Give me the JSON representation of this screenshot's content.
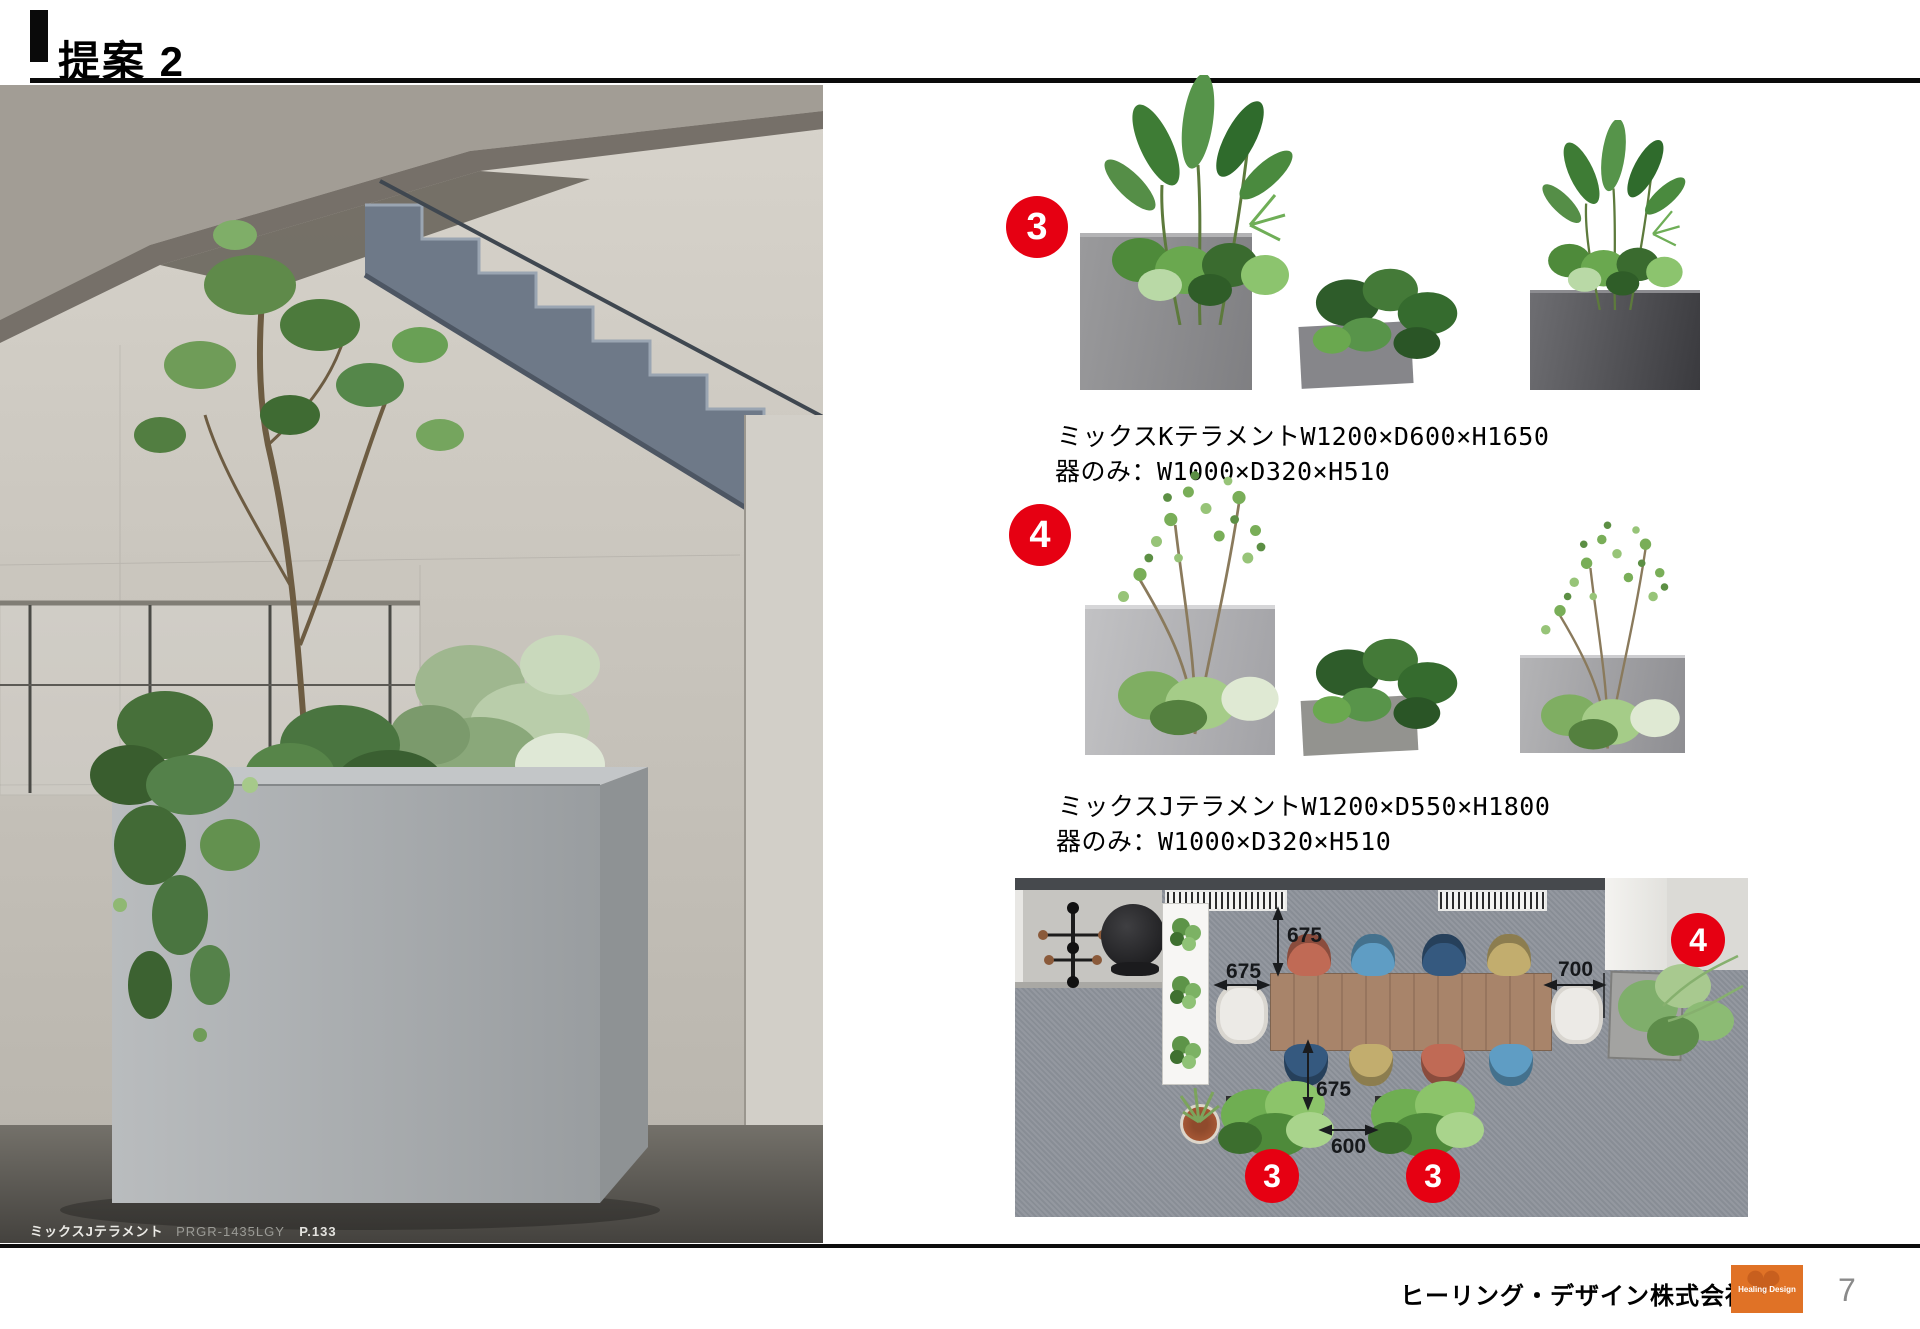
{
  "header": {
    "title": "提案 2"
  },
  "photo": {
    "caption": {
      "name": "ミックスJテラメント",
      "code": "PRGR-1435LGY",
      "page_ref": "P.133"
    }
  },
  "products": [
    {
      "number": "3",
      "name_dims": "ミックスKテラメントW1200×D600×H1650",
      "vessel_dims": "器のみ：W1000×D320×H510"
    },
    {
      "number": "4",
      "name_dims": "ミックスJテラメントW1200×D550×H1800",
      "vessel_dims": "器のみ：W1000×D320×H510"
    }
  ],
  "floorplan": {
    "dimensions": {
      "top_span": "675",
      "left_span": "675",
      "right_span": "700",
      "bottom_span": "675",
      "gap_span": "600"
    },
    "markers": [
      "3",
      "3",
      "4"
    ]
  },
  "footer": {
    "company": "ヒーリング・デザイン株式会社",
    "logo_text": "Healing Design",
    "page_number": "7"
  },
  "colors": {
    "marker_red": "#e60012",
    "logo_orange": "#e07226",
    "rule_black": "#0a0a0a"
  }
}
